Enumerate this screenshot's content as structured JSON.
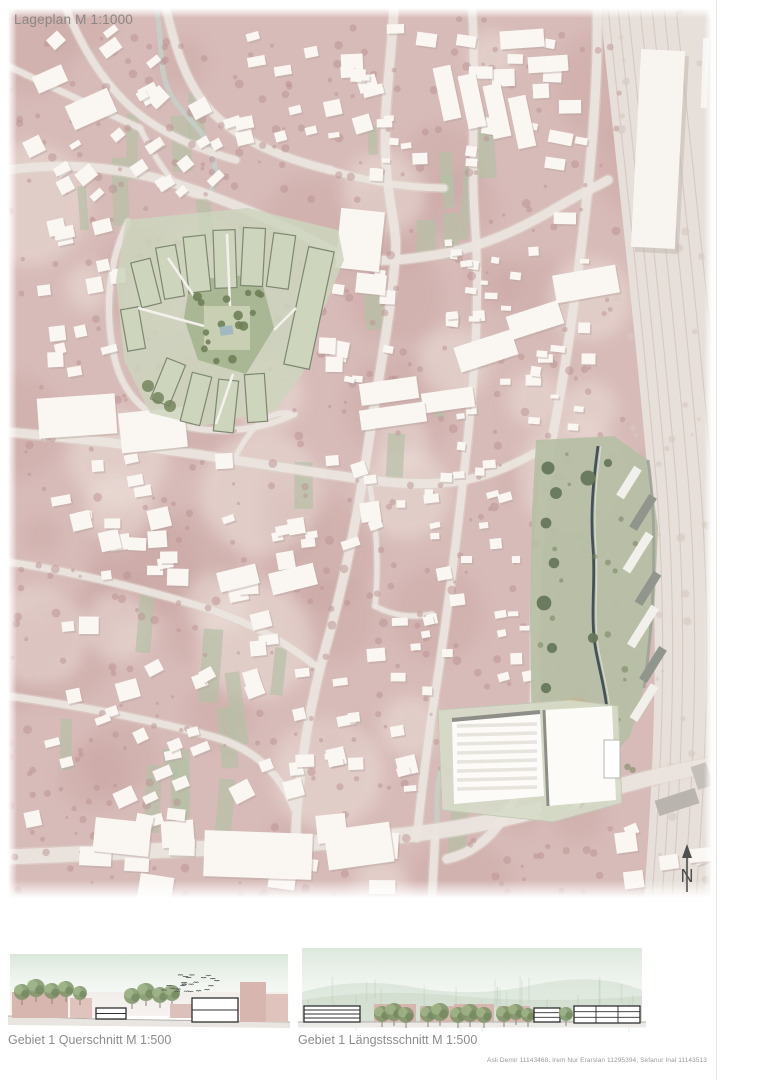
{
  "map": {
    "title": "Lageplan M 1:1000",
    "scale": "1:1000",
    "north_label": "N"
  },
  "sections": [
    {
      "label": "Gebiet 1 Querschnitt M 1:500",
      "scale": "1:500"
    },
    {
      "label": "Gebiet 1 Längstsschnitt M 1:500",
      "scale": "1:500"
    }
  ],
  "credits": "Asli Demir 11143468, Irem Nur Erarslan 11295394, Sefanur Inal 11143513",
  "palette": {
    "page_bg": "#ffffff",
    "map_base": "#d7bbb8",
    "map_blotch_dark": "#c49d9b",
    "map_blotch_light": "#ecdfd9",
    "tree_dot": "#b99291",
    "building_fill": "#faf7f3",
    "building_shadow": "#b9a7a2",
    "road": "#ebe4de",
    "road_casing": "#e0d6ce",
    "green_patch": "#b5c0a6",
    "project_green": "#cdd5bd",
    "project_green_dark": "#7d8870",
    "courtyard": "#aab795",
    "courtyard_light": "#c8cfb2",
    "tree_green": "#6f7f58",
    "park_green": "#b6bfa5",
    "park_tree": "#66775c",
    "stream_dark": "#43525a",
    "stream_light": "#c5d0c8",
    "sand": "#c8b28c",
    "railway_band": "#e7dfd9",
    "railway_track": "#cfc3bb",
    "gray_building": "#b9b4ae",
    "section_sky": "#d9e6d9",
    "section_pink": "#d8b6b0",
    "section_tree": "#7e9468",
    "ground_line": "#b3b0ab",
    "outline_dark": "#2f2f2f",
    "label_gray": "#8c8c8c",
    "credits_gray": "#9a9a9a",
    "north_arrow": "#4f4f4f"
  }
}
